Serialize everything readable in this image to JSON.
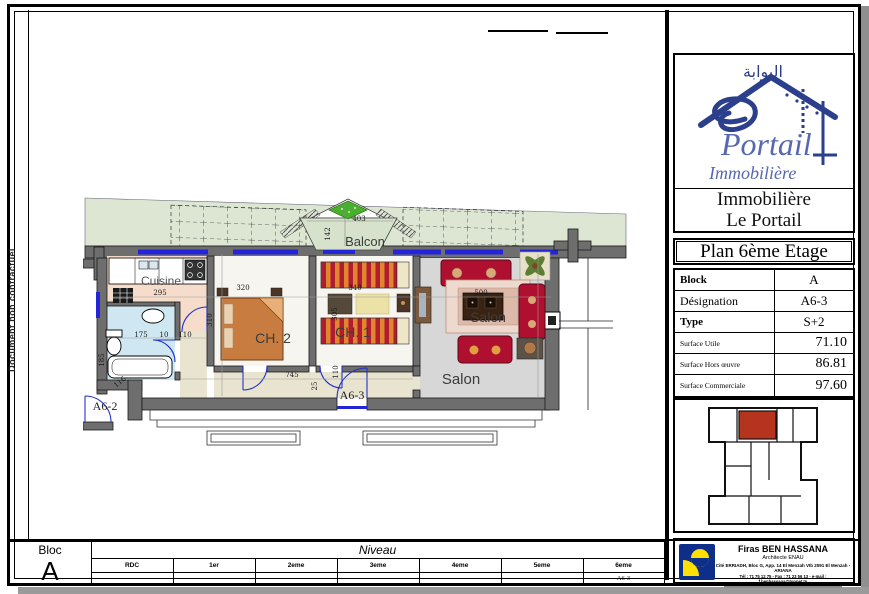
{
  "side_note": "Document non contractuel",
  "plan": {
    "labels": {
      "balcon": "Balcon",
      "cuisine": "Cuisine",
      "ch2": "CH. 2",
      "ch1": "CH. 1",
      "salon_center": "Salon",
      "salon_bottom": "Salon",
      "unit_current": "A6-3",
      "unit_neighbor": "A6-2"
    },
    "dims": {
      "d403": "403",
      "d142": "142",
      "d295": "295",
      "d320": "320",
      "d310": "310",
      "d340": "340",
      "d305": "305",
      "d500": "500",
      "d745": "745",
      "d175": "175",
      "d10": "10",
      "d110a": "110",
      "d185": "185",
      "d116": "116",
      "d110b": "110",
      "d25": "25"
    }
  },
  "panel": {
    "logo": {
      "arabic": "البوابة",
      "script_name": "Portail",
      "script_tag": "Immobilière",
      "name_line1": "Immobilière",
      "name_line2": "Le Portail"
    },
    "title": "Plan 6ème Etage",
    "specs": {
      "rows": [
        {
          "label": "Block",
          "value": "A"
        },
        {
          "label": "Désignation",
          "value": "A6-3"
        },
        {
          "label": "Type",
          "value": "S+2"
        },
        {
          "label": "Surface Utile",
          "value": "71.10"
        },
        {
          "label": "Surface Hors œuvre",
          "value": "86.81"
        },
        {
          "label": "Surface Commerciale",
          "value": "97.60"
        }
      ]
    },
    "architect": {
      "name": "Firas BEN HASSANA",
      "role": "Architecte ENAU",
      "address": "Cité ERRIADH, Bloc G, App. 14 El Menzah VIb 2091 El Menzah - ARIANA",
      "contact": "Tél : 71 75 12 75 - Fax : 71 23 56 13 - e-mail : f.benhassana@topnet.tn"
    }
  },
  "footer": {
    "bloc_label": "Bloc",
    "bloc_value": "A",
    "niveau_label": "Niveau",
    "levels": [
      "RDC",
      "1er",
      "2eme",
      "3eme",
      "4eme",
      "5eme",
      "6eme"
    ],
    "values": [
      "",
      "",
      "",
      "",
      "",
      "",
      "A6-3"
    ]
  },
  "colors": {
    "unit_highlight": "#b5341e",
    "window_blue": "#2424d8",
    "logo_blue": "#2b3f8c",
    "arch_logo_blue": "#0d2f8a",
    "arch_logo_yellow": "#ffe000"
  }
}
